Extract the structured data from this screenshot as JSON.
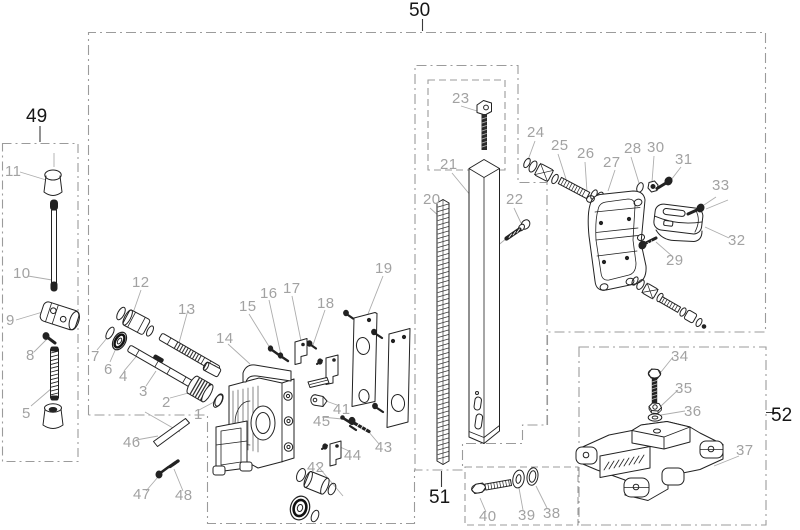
{
  "diagram": {
    "type": "exploded-parts-diagram",
    "total_callouts": 52,
    "colors": {
      "line": "#222222",
      "part_label": "#a2a2a2",
      "group_label": "#161616",
      "boundary": "#9b9b9b",
      "background": "#ffffff"
    },
    "part_labels": [
      {
        "n": "1",
        "x": 194,
        "y": 419
      },
      {
        "n": "2",
        "x": 162,
        "y": 407
      },
      {
        "n": "3",
        "x": 139,
        "y": 396
      },
      {
        "n": "4",
        "x": 119,
        "y": 381
      },
      {
        "n": "5",
        "x": 22,
        "y": 418
      },
      {
        "n": "6",
        "x": 104,
        "y": 374
      },
      {
        "n": "7",
        "x": 91,
        "y": 361
      },
      {
        "n": "8",
        "x": 26,
        "y": 360
      },
      {
        "n": "9",
        "x": 6,
        "y": 325
      },
      {
        "n": "10",
        "x": 13,
        "y": 278
      },
      {
        "n": "11",
        "x": 5,
        "y": 176
      },
      {
        "n": "12",
        "x": 132,
        "y": 287
      },
      {
        "n": "13",
        "x": 178,
        "y": 314
      },
      {
        "n": "14",
        "x": 216,
        "y": 343
      },
      {
        "n": "15",
        "x": 239,
        "y": 311
      },
      {
        "n": "16",
        "x": 260,
        "y": 298
      },
      {
        "n": "17",
        "x": 283,
        "y": 293
      },
      {
        "n": "18",
        "x": 317,
        "y": 308
      },
      {
        "n": "19",
        "x": 375,
        "y": 273
      },
      {
        "n": "20",
        "x": 423,
        "y": 204
      },
      {
        "n": "21",
        "x": 440,
        "y": 169
      },
      {
        "n": "22",
        "x": 506,
        "y": 204
      },
      {
        "n": "23",
        "x": 452,
        "y": 103
      },
      {
        "n": "24",
        "x": 527,
        "y": 137
      },
      {
        "n": "25",
        "x": 551,
        "y": 150
      },
      {
        "n": "26",
        "x": 577,
        "y": 158
      },
      {
        "n": "27",
        "x": 603,
        "y": 167
      },
      {
        "n": "28",
        "x": 624,
        "y": 153
      },
      {
        "n": "29",
        "x": 666,
        "y": 265
      },
      {
        "n": "30",
        "x": 647,
        "y": 152
      },
      {
        "n": "31",
        "x": 675,
        "y": 164
      },
      {
        "n": "32",
        "x": 728,
        "y": 245
      },
      {
        "n": "33",
        "x": 712,
        "y": 190
      },
      {
        "n": "34",
        "x": 671,
        "y": 361
      },
      {
        "n": "35",
        "x": 675,
        "y": 393
      },
      {
        "n": "36",
        "x": 684,
        "y": 416
      },
      {
        "n": "37",
        "x": 736,
        "y": 455
      },
      {
        "n": "38",
        "x": 543,
        "y": 518
      },
      {
        "n": "39",
        "x": 518,
        "y": 520
      },
      {
        "n": "40",
        "x": 479,
        "y": 521
      },
      {
        "n": "41",
        "x": 333,
        "y": 414
      },
      {
        "n": "42",
        "x": 307,
        "y": 472
      },
      {
        "n": "43",
        "x": 375,
        "y": 452
      },
      {
        "n": "44",
        "x": 344,
        "y": 460
      },
      {
        "n": "45",
        "x": 313,
        "y": 426
      },
      {
        "n": "46",
        "x": 123,
        "y": 447
      },
      {
        "n": "47",
        "x": 133,
        "y": 499
      },
      {
        "n": "48",
        "x": 175,
        "y": 500
      }
    ],
    "group_labels": [
      {
        "n": "49",
        "x": 26,
        "y": 122
      },
      {
        "n": "50",
        "x": 409,
        "y": 16
      },
      {
        "n": "51",
        "x": 429,
        "y": 503
      },
      {
        "n": "52",
        "x": 771,
        "y": 421
      }
    ]
  }
}
